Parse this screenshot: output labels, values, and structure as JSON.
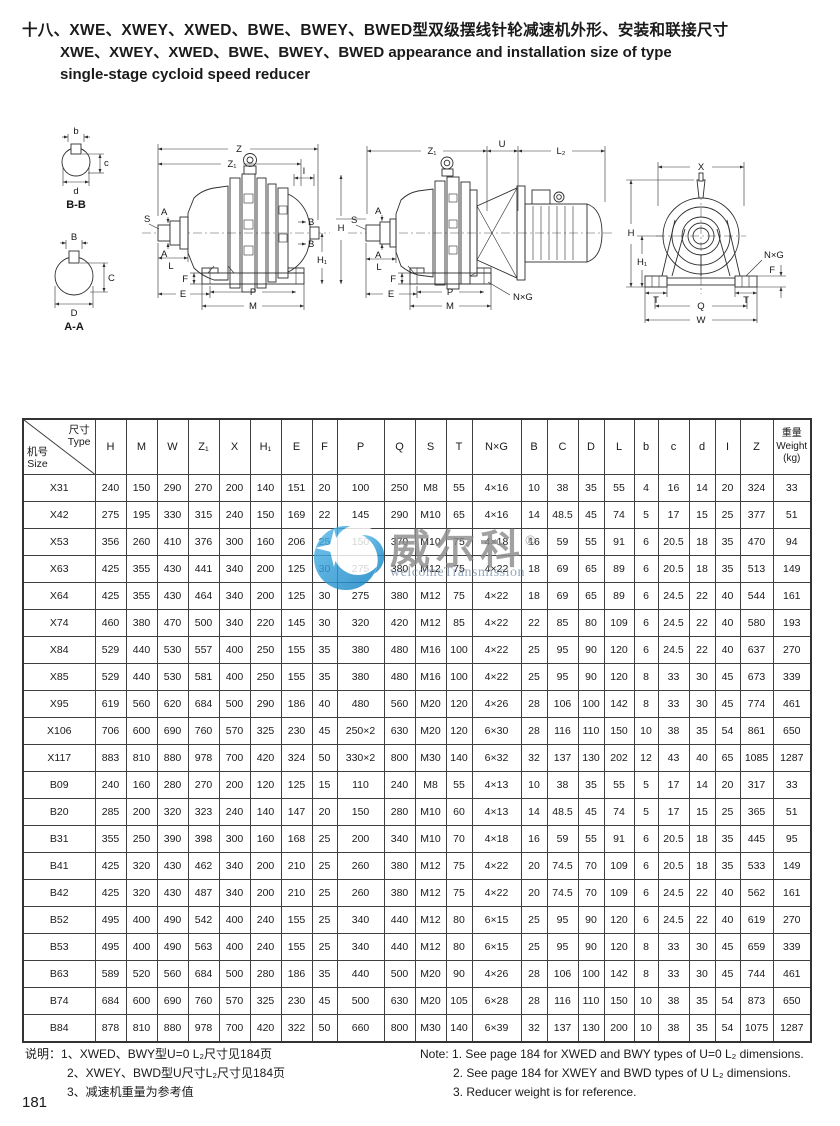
{
  "title": {
    "line1_zh": "十八、XWE、XWEY、XWED、BWE、BWEY、BWED型双级摆线针轮减速机外形、安装和联接尺寸",
    "line2_en": "XWE、XWEY、XWED、BWE、BWEY、BWED appearance and installation size of type",
    "line3_en": "single-stage cycloid speed reducer"
  },
  "drawings": {
    "section_bb": {
      "title": "B-B",
      "b": "b",
      "c": "c",
      "d": "d"
    },
    "section_aa": {
      "title": "A-A",
      "B": "B",
      "C": "C",
      "D": "D"
    },
    "side": {
      "Z": "Z",
      "Z1": "Z₁",
      "I": "I",
      "S": "S",
      "A1": "A",
      "A2": "A",
      "L": "L",
      "F": "F",
      "E": "E",
      "P": "P",
      "M": "M",
      "B1": "B",
      "B2": "B",
      "H1": "H₁"
    },
    "side_motor": {
      "Z1": "Z₁",
      "U": "U",
      "L2": "L₂",
      "H": "H",
      "S": "S",
      "A1": "A",
      "A2": "A",
      "L": "L",
      "F": "F",
      "E": "E",
      "P": "P",
      "M": "M",
      "NxG": "N×G"
    },
    "front": {
      "X": "X",
      "H": "H",
      "H1": "H₁",
      "NxG": "N×G",
      "F": "F",
      "T1": "T",
      "T2": "T",
      "Q": "Q",
      "W": "W"
    }
  },
  "watermark": {
    "chinese": "威尔科",
    "registered": "®",
    "subtitle": "welcomeTransmission"
  },
  "table": {
    "header": {
      "corner_top1": "尺寸",
      "corner_top2": "Type",
      "corner_bottom1": "机号",
      "corner_bottom2": "Size",
      "columns": [
        "H",
        "M",
        "W",
        "Z₁",
        "X",
        "H₁",
        "E",
        "F",
        "P",
        "Q",
        "S",
        "T",
        "N×G",
        "B",
        "C",
        "D",
        "L",
        "b",
        "c",
        "d",
        "I",
        "Z"
      ],
      "weight_zh": "重量",
      "weight_en": "Weight",
      "weight_unit": "(kg)"
    },
    "rows": [
      {
        "model": "X31",
        "values": [
          "240",
          "150",
          "290",
          "270",
          "200",
          "140",
          "151",
          "20",
          "100",
          "250",
          "M8",
          "55",
          "4×16",
          "10",
          "38",
          "35",
          "55",
          "4",
          "16",
          "14",
          "20",
          "324",
          "33"
        ]
      },
      {
        "model": "X42",
        "values": [
          "275",
          "195",
          "330",
          "315",
          "240",
          "150",
          "169",
          "22",
          "145",
          "290",
          "M10",
          "65",
          "4×16",
          "14",
          "48.5",
          "45",
          "74",
          "5",
          "17",
          "15",
          "25",
          "377",
          "51"
        ]
      },
      {
        "model": "X53",
        "values": [
          "356",
          "260",
          "410",
          "376",
          "300",
          "160",
          "206",
          "25",
          "150",
          "370",
          "M10",
          "75",
          "4×18",
          "16",
          "59",
          "55",
          "91",
          "6",
          "20.5",
          "18",
          "35",
          "470",
          "94"
        ]
      },
      {
        "model": "X63",
        "values": [
          "425",
          "355",
          "430",
          "441",
          "340",
          "200",
          "125",
          "30",
          "275",
          "380",
          "M12",
          "75",
          "4×22",
          "18",
          "69",
          "65",
          "89",
          "6",
          "20.5",
          "18",
          "35",
          "513",
          "149"
        ]
      },
      {
        "model": "X64",
        "values": [
          "425",
          "355",
          "430",
          "464",
          "340",
          "200",
          "125",
          "30",
          "275",
          "380",
          "M12",
          "75",
          "4×22",
          "18",
          "69",
          "65",
          "89",
          "6",
          "24.5",
          "22",
          "40",
          "544",
          "161"
        ]
      },
      {
        "model": "X74",
        "values": [
          "460",
          "380",
          "470",
          "500",
          "340",
          "220",
          "145",
          "30",
          "320",
          "420",
          "M12",
          "85",
          "4×22",
          "22",
          "85",
          "80",
          "109",
          "6",
          "24.5",
          "22",
          "40",
          "580",
          "193"
        ]
      },
      {
        "model": "X84",
        "values": [
          "529",
          "440",
          "530",
          "557",
          "400",
          "250",
          "155",
          "35",
          "380",
          "480",
          "M16",
          "100",
          "4×22",
          "25",
          "95",
          "90",
          "120",
          "6",
          "24.5",
          "22",
          "40",
          "637",
          "270"
        ]
      },
      {
        "model": "X85",
        "values": [
          "529",
          "440",
          "530",
          "581",
          "400",
          "250",
          "155",
          "35",
          "380",
          "480",
          "M16",
          "100",
          "4×22",
          "25",
          "95",
          "90",
          "120",
          "8",
          "33",
          "30",
          "45",
          "673",
          "339"
        ]
      },
      {
        "model": "X95",
        "values": [
          "619",
          "560",
          "620",
          "684",
          "500",
          "290",
          "186",
          "40",
          "480",
          "560",
          "M20",
          "120",
          "4×26",
          "28",
          "106",
          "100",
          "142",
          "8",
          "33",
          "30",
          "45",
          "774",
          "461"
        ]
      },
      {
        "model": "X106",
        "values": [
          "706",
          "600",
          "690",
          "760",
          "570",
          "325",
          "230",
          "45",
          "250×2",
          "630",
          "M20",
          "120",
          "6×30",
          "28",
          "116",
          "110",
          "150",
          "10",
          "38",
          "35",
          "54",
          "861",
          "650"
        ]
      },
      {
        "model": "X117",
        "values": [
          "883",
          "810",
          "880",
          "978",
          "700",
          "420",
          "324",
          "50",
          "330×2",
          "800",
          "M30",
          "140",
          "6×32",
          "32",
          "137",
          "130",
          "202",
          "12",
          "43",
          "40",
          "65",
          "1085",
          "1287"
        ]
      },
      {
        "model": "B09",
        "values": [
          "240",
          "160",
          "280",
          "270",
          "200",
          "120",
          "125",
          "15",
          "110",
          "240",
          "M8",
          "55",
          "4×13",
          "10",
          "38",
          "35",
          "55",
          "5",
          "17",
          "14",
          "20",
          "317",
          "33"
        ]
      },
      {
        "model": "B20",
        "values": [
          "285",
          "200",
          "320",
          "323",
          "240",
          "140",
          "147",
          "20",
          "150",
          "280",
          "M10",
          "60",
          "4×13",
          "14",
          "48.5",
          "45",
          "74",
          "5",
          "17",
          "15",
          "25",
          "365",
          "51"
        ]
      },
      {
        "model": "B31",
        "values": [
          "355",
          "250",
          "390",
          "398",
          "300",
          "160",
          "168",
          "25",
          "200",
          "340",
          "M10",
          "70",
          "4×18",
          "16",
          "59",
          "55",
          "91",
          "6",
          "20.5",
          "18",
          "35",
          "445",
          "95"
        ]
      },
      {
        "model": "B41",
        "values": [
          "425",
          "320",
          "430",
          "462",
          "340",
          "200",
          "210",
          "25",
          "260",
          "380",
          "M12",
          "75",
          "4×22",
          "20",
          "74.5",
          "70",
          "109",
          "6",
          "20.5",
          "18",
          "35",
          "533",
          "149"
        ]
      },
      {
        "model": "B42",
        "values": [
          "425",
          "320",
          "430",
          "487",
          "340",
          "200",
          "210",
          "25",
          "260",
          "380",
          "M12",
          "75",
          "4×22",
          "20",
          "74.5",
          "70",
          "109",
          "6",
          "24.5",
          "22",
          "40",
          "562",
          "161"
        ]
      },
      {
        "model": "B52",
        "values": [
          "495",
          "400",
          "490",
          "542",
          "400",
          "240",
          "155",
          "25",
          "340",
          "440",
          "M12",
          "80",
          "6×15",
          "25",
          "95",
          "90",
          "120",
          "6",
          "24.5",
          "22",
          "40",
          "619",
          "270"
        ]
      },
      {
        "model": "B53",
        "values": [
          "495",
          "400",
          "490",
          "563",
          "400",
          "240",
          "155",
          "25",
          "340",
          "440",
          "M12",
          "80",
          "6×15",
          "25",
          "95",
          "90",
          "120",
          "8",
          "33",
          "30",
          "45",
          "659",
          "339"
        ]
      },
      {
        "model": "B63",
        "values": [
          "589",
          "520",
          "560",
          "684",
          "500",
          "280",
          "186",
          "35",
          "440",
          "500",
          "M20",
          "90",
          "4×26",
          "28",
          "106",
          "100",
          "142",
          "8",
          "33",
          "30",
          "45",
          "744",
          "461"
        ]
      },
      {
        "model": "B74",
        "values": [
          "684",
          "600",
          "690",
          "760",
          "570",
          "325",
          "230",
          "45",
          "500",
          "630",
          "M20",
          "105",
          "6×28",
          "28",
          "116",
          "110",
          "150",
          "10",
          "38",
          "35",
          "54",
          "873",
          "650"
        ]
      },
      {
        "model": "B84",
        "values": [
          "878",
          "810",
          "880",
          "978",
          "700",
          "420",
          "322",
          "50",
          "660",
          "800",
          "M30",
          "140",
          "6×39",
          "32",
          "137",
          "130",
          "200",
          "10",
          "38",
          "35",
          "54",
          "1075",
          "1287"
        ]
      }
    ]
  },
  "notes": {
    "zh": {
      "label": "说明：",
      "items": [
        "1、XWED、BWY型U=0 L₂尺寸见184页",
        "2、XWEY、BWD型U尺寸L₂尺寸见184页",
        "3、减速机重量为参考值"
      ]
    },
    "en": {
      "label": "Note:",
      "items": [
        "1. See page 184 for XWED and BWY types of U=0 L₂ dimensions.",
        "2. See page 184 for XWEY and BWD types of U L₂ dimensions.",
        "3. Reducer weight is for reference."
      ]
    }
  },
  "page_number": "181"
}
